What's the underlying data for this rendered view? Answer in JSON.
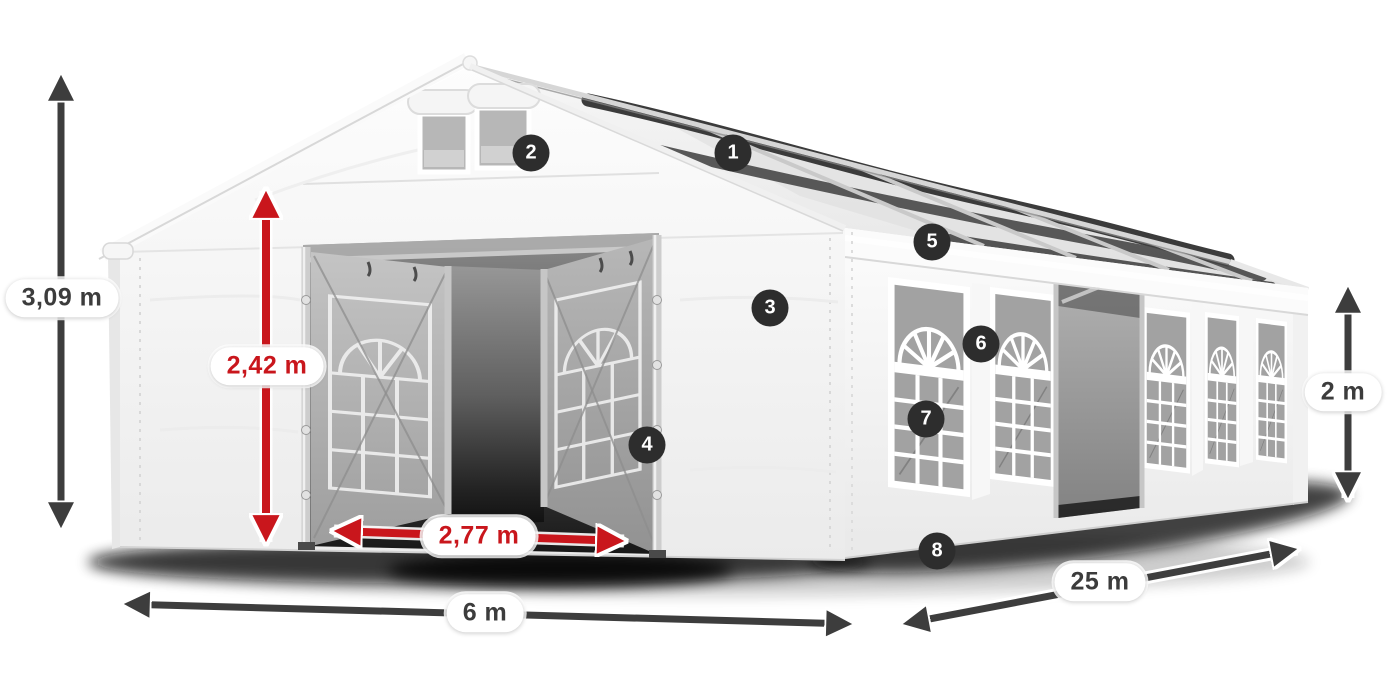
{
  "dimensions": {
    "total_height": {
      "label": "3,09 m"
    },
    "entrance_height": {
      "label": "2,42 m"
    },
    "entrance_width": {
      "label": "2,77 m"
    },
    "width": {
      "label": "6 m"
    },
    "length": {
      "label": "25 m"
    },
    "side_height": {
      "label": "2 m"
    }
  },
  "feature_markers": [
    "1",
    "2",
    "3",
    "4",
    "5",
    "6",
    "7",
    "8"
  ],
  "colors": {
    "dimension_red": "#c9161c",
    "dimension_dark": "#3d3d3d",
    "marker_badge_bg": "#2d2d2d",
    "marker_badge_text": "#ffffff",
    "tent_white": "#f4f4f4",
    "glass_grey": "#a2a2a2"
  }
}
